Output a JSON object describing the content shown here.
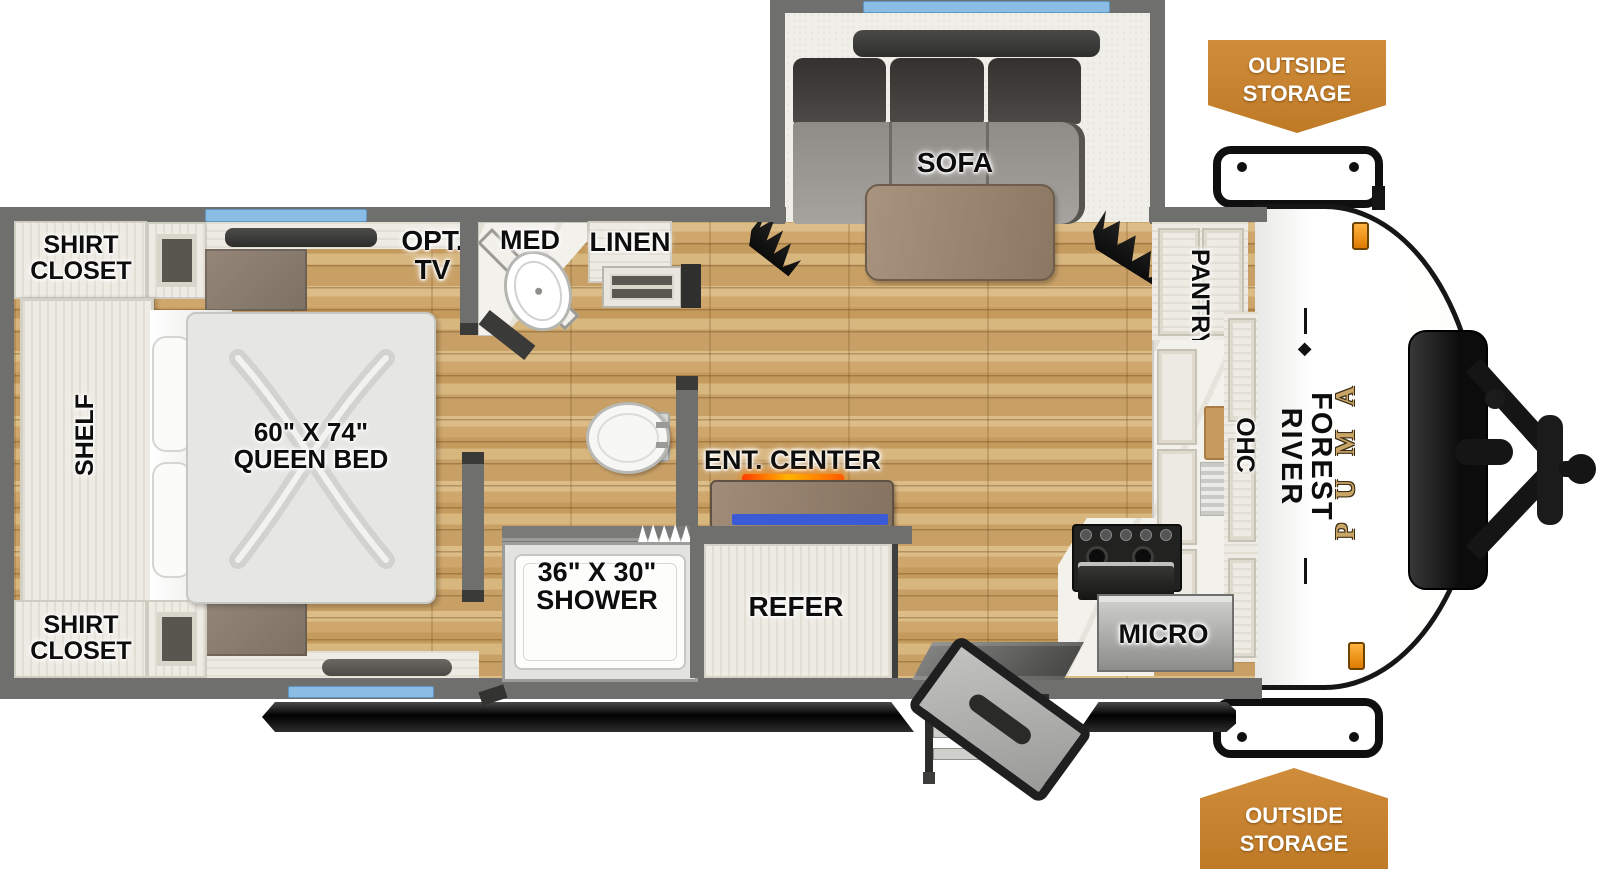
{
  "title": "Forest River Puma travel trailer floor plan",
  "bedroom": {
    "shirt_closet_top_line1": "SHIRT",
    "shirt_closet_top_line2": "CLOSET",
    "shirt_closet_bottom_line1": "SHIRT",
    "shirt_closet_bottom_line2": "CLOSET",
    "shelf": "SHELF",
    "bed_line1": "60\" X 74\"",
    "bed_line2": "QUEEN BED",
    "opt_tv_line1": "OPT.",
    "opt_tv_line2": "TV"
  },
  "bathroom": {
    "med": "MED",
    "linen": "LINEN",
    "shower_line1": "36\" X 30\"",
    "shower_line2": "SHOWER"
  },
  "living": {
    "sofa": "SOFA",
    "ent_center": "ENT. CENTER",
    "refer": "REFER"
  },
  "kitchen": {
    "pantry": "PANTRY",
    "ohc": "OHC",
    "micro": "MICRO"
  },
  "exterior": {
    "storage_top_line1": "OUTSIDE",
    "storage_top_line2": "STORAGE",
    "storage_bottom_line1": "OUTSIDE",
    "storage_bottom_line2": "STORAGE",
    "brand": "FOREST RIVER",
    "model": "PUMA"
  },
  "colors": {
    "wall_gray": "#6f6f6d",
    "wood_floor": "#cfa76c",
    "badge_orange": "#c8822e",
    "window_blue": "#8bbde4",
    "puma_gold": "#c9a567",
    "fireplace_orange": "#ff6a00",
    "ent_center_blue": "#3b5bd6"
  }
}
